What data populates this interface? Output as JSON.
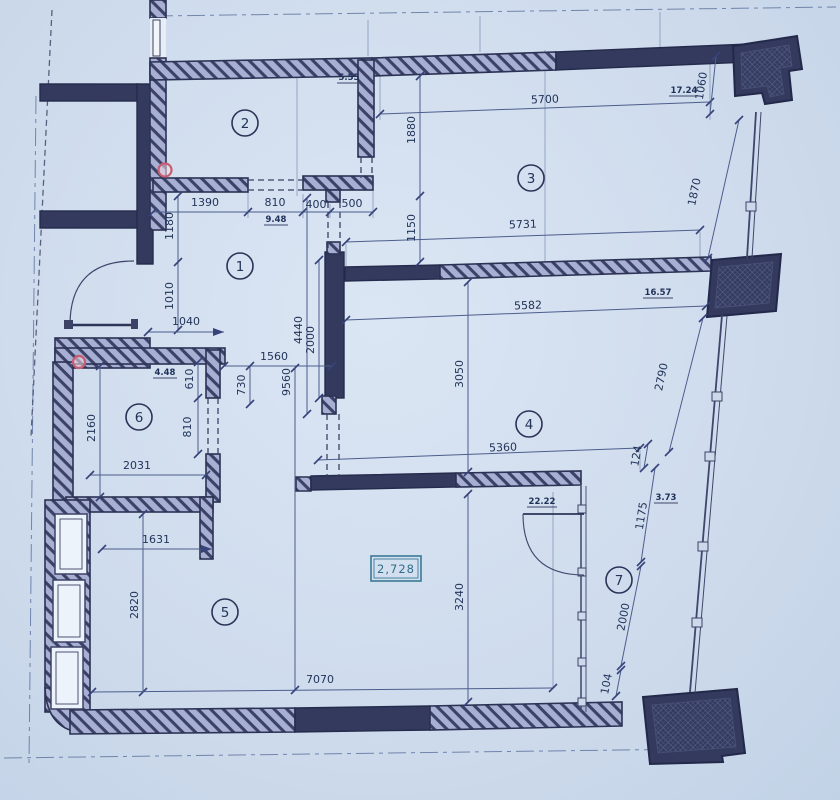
{
  "document": {
    "type": "architectural floor plan",
    "units": "mm"
  },
  "colors": {
    "paper": "#cfdced",
    "wall_solid": "#333a5e",
    "wall_hatch_bg": "#a7afd3",
    "dim_line": "#4d5d8c",
    "dim_text": "#223459",
    "marker_red": "#c75d72",
    "elevation_teal": "#2e6e8a"
  },
  "rooms": {
    "r1": "1",
    "r2": "2",
    "r3": "3",
    "r4": "4",
    "r5": "5",
    "r6": "6",
    "r7": "7"
  },
  "areas": {
    "hall": "9.48",
    "room2": "5.55",
    "room3": "17.24",
    "room4": "16.57",
    "room5": "22.22",
    "room6": "4.48",
    "room7": "3.73"
  },
  "elevation_mark": "2,728",
  "dimensions": {
    "d1390": "1390",
    "d810_top": "810",
    "d400": "400",
    "d500": "500",
    "d5700": "5700",
    "d1880": "1880",
    "d1150": "1150",
    "d5731": "5731",
    "d1060": "1060",
    "d1870": "1870",
    "d17_24": "17.24",
    "d1180": "1180",
    "d1010": "1010",
    "d1040": "1040",
    "d4440": "4440",
    "d2000_center": "2000",
    "d9560": "9560",
    "d1560": "1560",
    "d730": "730",
    "d610": "610",
    "d810_room6": "810",
    "d2160": "2160",
    "d2031": "2031",
    "d1631": "1631",
    "d2820": "2820",
    "d7070": "7070",
    "d5582": "5582",
    "d3050": "3050",
    "d2790": "2790",
    "d5360": "5360",
    "d124": "124",
    "d1175": "1175",
    "d3240": "3240",
    "d2000_right": "2000",
    "d104": "104"
  }
}
